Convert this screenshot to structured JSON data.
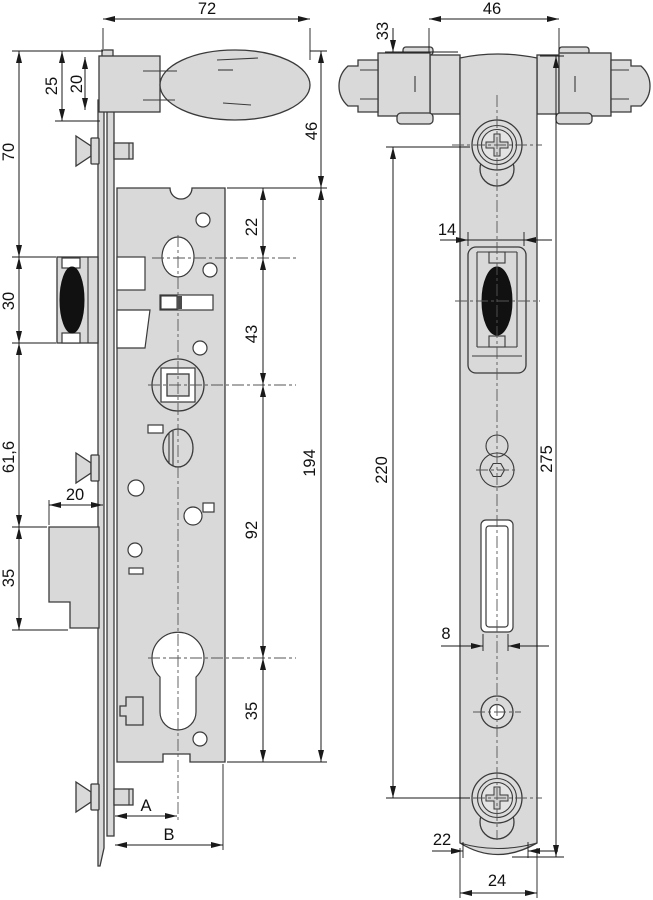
{
  "colors": {
    "part_fill": "#d9d9d9",
    "outline": "#3a3a3a",
    "bolt_fill": "#111111",
    "background": "#ffffff"
  },
  "left_view": {
    "dims": {
      "handle_width": "72",
      "rose_outer_height": "25",
      "rose_height": "20",
      "top_to_latch": "70",
      "handle_to_case_top": "46",
      "case_top_to_hole": "22",
      "hole_to_spindle": "43",
      "latch_height": "30",
      "latch_to_bolt": "61,6",
      "case_height": "194",
      "bolt_throw": "20",
      "spindle_to_cylinder": "92",
      "bolt_height": "35",
      "cylinder_to_case_bottom": "35",
      "backset": "A",
      "case_depth": "B"
    }
  },
  "right_view": {
    "dims": {
      "rose_span": "46",
      "top_to_screw": "33",
      "latch_width": "14",
      "screw_spacing": "220",
      "faceplate_length": "275",
      "bolt_slot_width": "8",
      "faceplate_end_width": "22",
      "faceplate_width": "24"
    }
  }
}
